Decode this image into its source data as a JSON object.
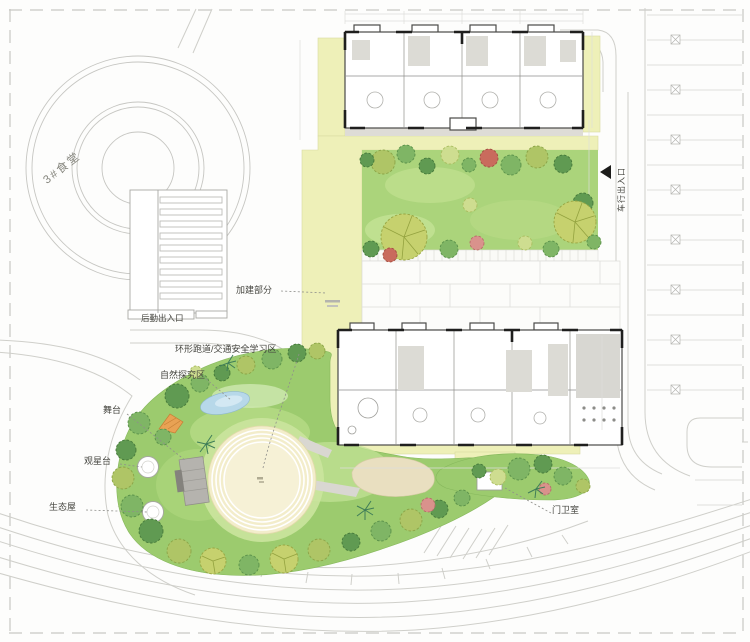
{
  "plan": {
    "type": "kindergarten-site-plan",
    "labels": {
      "canteen": "3#食堂",
      "logistics_entrance": "后勤出入口",
      "addition_part": "加建部分",
      "ring_track": "环形跑道/交通安全学习区",
      "nature_explore": "自然探究区",
      "stage": "舞台",
      "stargazing": "观星台",
      "eco_house": "生态屋",
      "guard_room": "门卫室",
      "vehicle_entrance": "车行出入口"
    },
    "colors": {
      "addition_yellow": "#eef0b8",
      "lawn_green": "#abd47b",
      "garden_green": "#9ccb6e",
      "track_cream": "#f3edcb",
      "sand_beige": "#e9dfc0",
      "pond_blue": "#b7d8e9",
      "road_line_gray": "#cfcfca",
      "building_wall": "#4a4a48",
      "label_text": "#45453f"
    }
  }
}
